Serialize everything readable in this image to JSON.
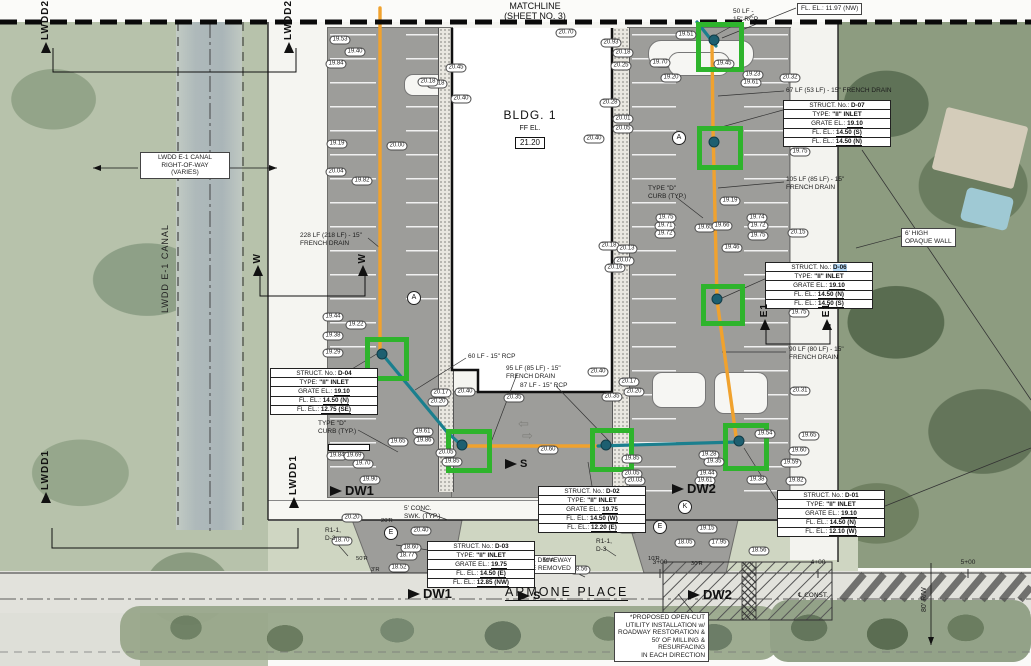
{
  "matchline": {
    "line1": "MATCHLINE",
    "line2": "(SHEET NO. 3)"
  },
  "building": {
    "name": "BLDG. 1",
    "ff_label": "FF EL.",
    "ff_value": "21.20"
  },
  "street": {
    "name": "ARMONE PLACE",
    "centerline_label": "℄ CONST.",
    "row_label": "80' R/W",
    "stations": [
      {
        "label": "2+00",
        "x": 510
      },
      {
        "label": "3+00",
        "x": 660
      },
      {
        "label": "4+00",
        "x": 818
      },
      {
        "label": "5+00",
        "x": 968
      }
    ]
  },
  "canal": {
    "name": "LWDD E-1 CANAL",
    "row_note": "LWDD E-1 CANAL\nRIGHT-OF-WAY\n(VARIES)"
  },
  "colors": {
    "french_drain": "#F0A22E",
    "rcp_pipe": "#1B7F8E",
    "highlight_box": "#2EB42C",
    "selection": "#B5D9F7",
    "pavement": "#9D9D9A"
  },
  "structures": [
    {
      "id": "D-07",
      "x": 783,
      "y": 100,
      "highlight": false,
      "rows": [
        [
          "STRUCT. No.:",
          "D-07"
        ],
        [
          "TYPE:",
          "\"II\" INLET"
        ],
        [
          "GRATE EL.:",
          "19.10"
        ],
        [
          "FL. EL.:",
          "14.50 (S)"
        ],
        [
          "FL. EL.:",
          "14.50 (N)"
        ]
      ]
    },
    {
      "id": "D-06",
      "x": 765,
      "y": 262,
      "highlight": true,
      "rows": [
        [
          "STRUCT. No.:",
          "D-06"
        ],
        [
          "TYPE:",
          "\"II\" INLET"
        ],
        [
          "GRATE EL.:",
          "19.10"
        ],
        [
          "FL. EL.:",
          "14.50 (N)"
        ],
        [
          "FL. EL.:",
          "14.50 (S)"
        ]
      ]
    },
    {
      "id": "D-04",
      "x": 270,
      "y": 368,
      "highlight": false,
      "rows": [
        [
          "STRUCT. No.:",
          "D-04"
        ],
        [
          "TYPE:",
          "\"II\" INLET"
        ],
        [
          "GRATE EL.:",
          "19.10"
        ],
        [
          "FL. EL.:",
          "14.50 (N)"
        ],
        [
          "FL. EL.:",
          "12.75 (SE)"
        ]
      ]
    },
    {
      "id": "D-02",
      "x": 538,
      "y": 486,
      "highlight": false,
      "rows": [
        [
          "STRUCT. No.:",
          "D-02"
        ],
        [
          "TYPE:",
          "\"II\" INLET"
        ],
        [
          "GRATE EL.:",
          "19.75"
        ],
        [
          "FL. EL.:",
          "14.50 (W)"
        ],
        [
          "FL. EL.:",
          "12.20 (E)"
        ]
      ]
    },
    {
      "id": "D-03",
      "x": 427,
      "y": 541,
      "highlight": false,
      "rows": [
        [
          "STRUCT. No.:",
          "D-03"
        ],
        [
          "TYPE:",
          "\"II\" INLET"
        ],
        [
          "GRATE EL.:",
          "19.75"
        ],
        [
          "FL. EL.:",
          "14.50 (E)"
        ],
        [
          "FL. EL.:",
          "12.85 (NW)"
        ]
      ]
    },
    {
      "id": "D-01",
      "x": 777,
      "y": 490,
      "highlight": false,
      "rows": [
        [
          "STRUCT. No.:",
          "D-01"
        ],
        [
          "TYPE:",
          "\"II\" INLET"
        ],
        [
          "GRATE EL.:",
          "19.10"
        ],
        [
          "FL. EL.:",
          "14.50 (N)"
        ],
        [
          "FL. EL.:",
          "12.10 (W)"
        ]
      ]
    }
  ],
  "callouts": [
    {
      "t": "50 LF -\n15\" RCP",
      "x": 733,
      "y": 8
    },
    {
      "t": "FL. EL.: 11.97 (NW)",
      "x": 797,
      "y": 3,
      "boxed": true
    },
    {
      "t": "67 LF (53 LF) - 15\" FRENCH DRAIN",
      "x": 786,
      "y": 87
    },
    {
      "t": "105 LF (85 LF) - 15\"\nFRENCH DRAIN",
      "x": 786,
      "y": 176
    },
    {
      "t": "6' HIGH\nOPAQUE WALL",
      "x": 901,
      "y": 228,
      "boxed": true
    },
    {
      "t": "90 LF (80 LF) - 15\"\nFRENCH DRAIN",
      "x": 789,
      "y": 346
    },
    {
      "t": "228 LF (218 LF) - 15\"\nFRENCH DRAIN",
      "x": 300,
      "y": 232
    },
    {
      "t": "60 LF - 15\" RCP",
      "x": 468,
      "y": 353
    },
    {
      "t": "95 LF (85 LF) - 15\"\nFRENCH DRAIN",
      "x": 506,
      "y": 365
    },
    {
      "t": "87 LF - 15\" RCP",
      "x": 520,
      "y": 382
    },
    {
      "t": "TYPE \"D\"\nCURB (TYP.)",
      "x": 648,
      "y": 185
    },
    {
      "t": "TYPE \"D\"\nCURB (TYP.)",
      "x": 318,
      "y": 420
    },
    {
      "t": "5' CONC.\nSWK. (TYP.)",
      "x": 404,
      "y": 505
    },
    {
      "t": "EXIST. DRIVEWAY\nTO BE REMOVED",
      "x": 512,
      "y": 555,
      "boxed": true,
      "align": "center"
    },
    {
      "t": "R1-1,\nD-3",
      "x": 325,
      "y": 527
    },
    {
      "t": "R1-1,\nD-3",
      "x": 596,
      "y": 538
    },
    {
      "t": "*PROPOSED OPEN-CUT\nUTILITY INSTALLATION w/\nROADWAY RESTORATION &\n50' OF MILLING &\nRESURFACING\nIN EACH DIRECTION",
      "x": 614,
      "y": 612,
      "boxed": true,
      "align": "right"
    }
  ],
  "radius_labels": [
    {
      "t": "50'R",
      "x": 356,
      "y": 556
    },
    {
      "t": "3'R",
      "x": 371,
      "y": 567
    },
    {
      "t": "20'R",
      "x": 381,
      "y": 518
    },
    {
      "t": "10'R",
      "x": 543,
      "y": 558
    },
    {
      "t": "10'R",
      "x": 648,
      "y": 556
    },
    {
      "t": "30'R",
      "x": 691,
      "y": 561
    }
  ],
  "section_markers": [
    {
      "label": "LWDD2",
      "x": 40,
      "y": 0
    },
    {
      "label": "LWDD2",
      "x": 283,
      "y": 0
    },
    {
      "label": "W",
      "x": 252,
      "y": 253
    },
    {
      "label": "W",
      "x": 357,
      "y": 253
    },
    {
      "label": "E1",
      "x": 759,
      "y": 303
    },
    {
      "label": "E1",
      "x": 821,
      "y": 303
    },
    {
      "label": "LWDD1",
      "x": 40,
      "y": 450
    },
    {
      "label": "LWDD1",
      "x": 288,
      "y": 455
    }
  ],
  "flow_markers": [
    {
      "label": "DW1",
      "x": 330,
      "y": 483,
      "size": "big"
    },
    {
      "label": "DW1",
      "x": 408,
      "y": 586,
      "size": "big"
    },
    {
      "label": "DW2",
      "x": 672,
      "y": 481,
      "size": "big"
    },
    {
      "label": "DW2",
      "x": 688,
      "y": 587,
      "size": "big"
    },
    {
      "label": "S",
      "x": 505,
      "y": 458,
      "size": "small"
    },
    {
      "label": "S",
      "x": 518,
      "y": 590,
      "size": "small"
    }
  ],
  "circle_markers": [
    {
      "l": "A",
      "x": 679,
      "y": 138
    },
    {
      "l": "A",
      "x": 414,
      "y": 298
    },
    {
      "l": "E",
      "x": 391,
      "y": 533
    },
    {
      "l": "E",
      "x": 660,
      "y": 527
    },
    {
      "l": "K",
      "x": 685,
      "y": 507
    }
  ],
  "green_boxes": [
    {
      "x": 696,
      "y": 22,
      "w": 38,
      "h": 40
    },
    {
      "x": 697,
      "y": 126,
      "w": 36,
      "h": 34
    },
    {
      "x": 701,
      "y": 284,
      "w": 34,
      "h": 32
    },
    {
      "x": 365,
      "y": 337,
      "w": 34,
      "h": 34
    },
    {
      "x": 446,
      "y": 429,
      "w": 36,
      "h": 34
    },
    {
      "x": 590,
      "y": 428,
      "w": 34,
      "h": 34
    },
    {
      "x": 723,
      "y": 423,
      "w": 36,
      "h": 38
    }
  ],
  "inlets": [
    {
      "x": 714,
      "y": 40
    },
    {
      "x": 714,
      "y": 142
    },
    {
      "x": 717,
      "y": 299
    },
    {
      "x": 382,
      "y": 354
    },
    {
      "x": 462,
      "y": 445
    },
    {
      "x": 606,
      "y": 445
    },
    {
      "x": 739,
      "y": 441
    }
  ],
  "spot_elevations": [
    {
      "v": "19.53",
      "x": 340,
      "y": 40
    },
    {
      "v": "19.40",
      "x": 355,
      "y": 52
    },
    {
      "v": "19.84",
      "x": 336,
      "y": 64
    },
    {
      "v": "20.18",
      "x": 437,
      "y": 84
    },
    {
      "v": "19.19",
      "x": 337,
      "y": 144
    },
    {
      "v": "20.00",
      "x": 397,
      "y": 146
    },
    {
      "v": "20.04",
      "x": 336,
      "y": 172
    },
    {
      "v": "19.82",
      "x": 362,
      "y": 181
    },
    {
      "v": "20.70",
      "x": 566,
      "y": 33
    },
    {
      "v": "20.93",
      "x": 611,
      "y": 43
    },
    {
      "v": "20.18",
      "x": 623,
      "y": 53
    },
    {
      "v": "20.25",
      "x": 621,
      "y": 66
    },
    {
      "v": "20.45",
      "x": 456,
      "y": 68
    },
    {
      "v": "20.18",
      "x": 428,
      "y": 82
    },
    {
      "v": "20.40",
      "x": 461,
      "y": 99
    },
    {
      "v": "20.28",
      "x": 610,
      "y": 103
    },
    {
      "v": "20.01",
      "x": 623,
      "y": 119
    },
    {
      "v": "20.05",
      "x": 623,
      "y": 129
    },
    {
      "v": "20.40",
      "x": 594,
      "y": 139
    },
    {
      "v": "19.51",
      "x": 686,
      "y": 35
    },
    {
      "v": "19.45",
      "x": 724,
      "y": 64
    },
    {
      "v": "19.70",
      "x": 660,
      "y": 63
    },
    {
      "v": "19.20",
      "x": 671,
      "y": 78
    },
    {
      "v": "19.23",
      "x": 753,
      "y": 75
    },
    {
      "v": "19.61",
      "x": 751,
      "y": 83
    },
    {
      "v": "20.32",
      "x": 790,
      "y": 78
    },
    {
      "v": "19.75",
      "x": 800,
      "y": 152
    },
    {
      "v": "20.15",
      "x": 798,
      "y": 233
    },
    {
      "v": "19.19",
      "x": 730,
      "y": 201
    },
    {
      "v": "19.75",
      "x": 666,
      "y": 218
    },
    {
      "v": "19.71",
      "x": 665,
      "y": 226
    },
    {
      "v": "19.72",
      "x": 665,
      "y": 234
    },
    {
      "v": "19.65",
      "x": 705,
      "y": 228
    },
    {
      "v": "19.66",
      "x": 722,
      "y": 226
    },
    {
      "v": "19.74",
      "x": 757,
      "y": 218
    },
    {
      "v": "19.72",
      "x": 758,
      "y": 226
    },
    {
      "v": "19.75",
      "x": 758,
      "y": 236
    },
    {
      "v": "19.46",
      "x": 732,
      "y": 248
    },
    {
      "v": "20.18",
      "x": 609,
      "y": 246
    },
    {
      "v": "20.13",
      "x": 627,
      "y": 249
    },
    {
      "v": "20.07",
      "x": 624,
      "y": 261
    },
    {
      "v": "20.16",
      "x": 615,
      "y": 268
    },
    {
      "v": "19.75",
      "x": 799,
      "y": 313
    },
    {
      "v": "20.31",
      "x": 800,
      "y": 391
    },
    {
      "v": "19.44",
      "x": 333,
      "y": 317
    },
    {
      "v": "19.22",
      "x": 356,
      "y": 325
    },
    {
      "v": "19.38",
      "x": 333,
      "y": 336
    },
    {
      "v": "19.29",
      "x": 333,
      "y": 353
    },
    {
      "v": "20.17",
      "x": 441,
      "y": 393
    },
    {
      "v": "20.20",
      "x": 438,
      "y": 402
    },
    {
      "v": "19.61",
      "x": 423,
      "y": 432
    },
    {
      "v": "19.86",
      "x": 424,
      "y": 441
    },
    {
      "v": "19.65",
      "x": 398,
      "y": 442
    },
    {
      "v": "19.84",
      "x": 337,
      "y": 456
    },
    {
      "v": "19.69",
      "x": 354,
      "y": 456
    },
    {
      "v": "19.70",
      "x": 363,
      "y": 464
    },
    {
      "v": "19.90",
      "x": 370,
      "y": 480
    },
    {
      "v": "20.05",
      "x": 446,
      "y": 453
    },
    {
      "v": "19.85",
      "x": 452,
      "y": 462
    },
    {
      "v": "20.20",
      "x": 352,
      "y": 518
    },
    {
      "v": "20.40",
      "x": 465,
      "y": 392
    },
    {
      "v": "20.35",
      "x": 514,
      "y": 398
    },
    {
      "v": "20.40",
      "x": 598,
      "y": 372
    },
    {
      "v": "20.17",
      "x": 629,
      "y": 382
    },
    {
      "v": "20.20",
      "x": 634,
      "y": 392
    },
    {
      "v": "20.35",
      "x": 612,
      "y": 397
    },
    {
      "v": "20.60",
      "x": 548,
      "y": 450
    },
    {
      "v": "19.85",
      "x": 632,
      "y": 459
    },
    {
      "v": "20.05",
      "x": 632,
      "y": 474
    },
    {
      "v": "20.03",
      "x": 635,
      "y": 481
    },
    {
      "v": "19.54",
      "x": 765,
      "y": 434
    },
    {
      "v": "19.65",
      "x": 809,
      "y": 436
    },
    {
      "v": "19.60",
      "x": 799,
      "y": 451
    },
    {
      "v": "19.59",
      "x": 791,
      "y": 463
    },
    {
      "v": "19.82",
      "x": 796,
      "y": 481
    },
    {
      "v": "19.38",
      "x": 757,
      "y": 480
    },
    {
      "v": "19.44",
      "x": 707,
      "y": 474
    },
    {
      "v": "19.61",
      "x": 705,
      "y": 481
    },
    {
      "v": "19.28",
      "x": 709,
      "y": 455
    },
    {
      "v": "19.35",
      "x": 714,
      "y": 462
    },
    {
      "v": "20.20",
      "x": 628,
      "y": 529
    },
    {
      "v": "19.15",
      "x": 707,
      "y": 529
    },
    {
      "v": "18.05",
      "x": 685,
      "y": 543
    },
    {
      "v": "17.95",
      "x": 719,
      "y": 543
    },
    {
      "v": "18.56",
      "x": 759,
      "y": 551
    },
    {
      "v": "20.40",
      "x": 421,
      "y": 531
    },
    {
      "v": "18.70",
      "x": 342,
      "y": 541
    },
    {
      "v": "18.60",
      "x": 411,
      "y": 548
    },
    {
      "v": "18.77",
      "x": 407,
      "y": 556
    },
    {
      "v": "18.52",
      "x": 399,
      "y": 568
    },
    {
      "v": "18.56",
      "x": 580,
      "y": 570
    }
  ]
}
